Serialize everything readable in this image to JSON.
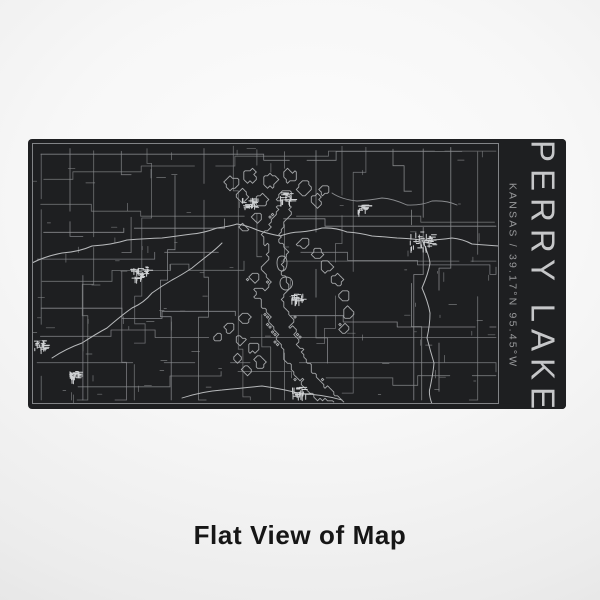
{
  "panel": {
    "title": "PERRY LAKE",
    "subtitle": "KANSAS / 39.17°N 95.45°W"
  },
  "caption": "Flat View of Map",
  "colors": {
    "panel_bg": "#1e1f21",
    "frame": "#828487",
    "roads": "#8a8c8f",
    "shoreline": "#a6a8aa",
    "highways": "#b7b9bb",
    "towns": "#d0d2d4",
    "title_text": "#c6c7c9",
    "subtitle_text": "#98999b",
    "caption_text": "#161616"
  }
}
